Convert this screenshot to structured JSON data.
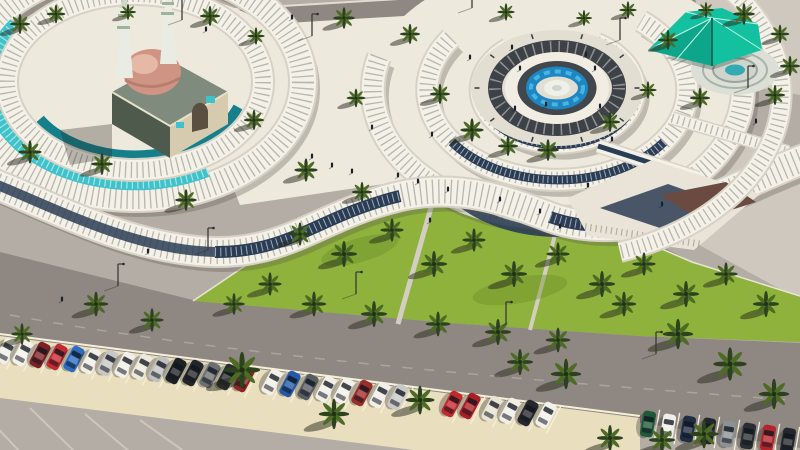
{
  "meta": {
    "type": "architectural-aerial-render",
    "description": "Aerial 3D architectural rendering of a mosque plaza: curved white lattice canopies spiral around a circular fountain plaza, a mosque with a pink dome and twin minarets sits inside a ringed arcade with teal glass, a teal tensile shade pavilion stands at the upper right, rows of palm trees cover a bright green lawn, and an angled parking strip full of colored cars runs along the bottom."
  },
  "labels": {
    "mosque": "mosque with dome and twin minarets",
    "arcade": "curved arcade with teal glass canopy",
    "fountain": "central circular fountain plaza",
    "pavilion": "teal tensile shade pavilion",
    "promenade": "curved shaded promenade walkway",
    "lawn": "palm grove lawn",
    "parking": "angled parking row",
    "road": "perimeter road"
  },
  "palette": {
    "base": "#b4ada5",
    "pavementLight": "#cfc8be",
    "road": "#8f8882",
    "roadUpper": "#989089",
    "plaza": "#eee9dd",
    "plazaBright": "#f4f1e8",
    "bandEdge": "#d7d2c5",
    "navy": "#2b3d55",
    "tealGlass": "#3fc3cb",
    "tealDark": "#157f8c",
    "lawn": "#8eb23c",
    "lawnDark": "#74982f",
    "palm": "#2c421c",
    "palmLight": "#4c6b24",
    "shadow": "rgba(38,40,28,0.5)",
    "parking": "#e9dfbf",
    "parkLine": "#f6f0da",
    "mosqueRoof": "#7e8b7d",
    "mosqueSide": "#4e5a4c",
    "mosqueFacade": "#d6cbae",
    "domeLight": "#e9c0ac",
    "domeDark": "#cf9483",
    "minaret": "#e9ece3",
    "minaretBand": "#9db39b",
    "pavilion": "#13c1a1",
    "pavilionDark": "#0b9078",
    "waterLight": "#47b4e4",
    "water": "#1e87c2",
    "fountainDark": "#3c4247",
    "person": "#1b212b"
  },
  "palms": [
    [
      20,
      24,
      0.7
    ],
    [
      56,
      14,
      0.65
    ],
    [
      128,
      12,
      0.55
    ],
    [
      210,
      16,
      0.7
    ],
    [
      256,
      36,
      0.6
    ],
    [
      344,
      18,
      0.75
    ],
    [
      410,
      34,
      0.7
    ],
    [
      506,
      12,
      0.6
    ],
    [
      584,
      18,
      0.55
    ],
    [
      628,
      10,
      0.6
    ],
    [
      668,
      40,
      0.7
    ],
    [
      706,
      10,
      0.55
    ],
    [
      744,
      14,
      0.75
    ],
    [
      780,
      34,
      0.65
    ],
    [
      790,
      66,
      0.7
    ],
    [
      30,
      152,
      0.8
    ],
    [
      102,
      164,
      0.75
    ],
    [
      254,
      120,
      0.7
    ],
    [
      306,
      170,
      0.8
    ],
    [
      186,
      200,
      0.75
    ],
    [
      356,
      98,
      0.65
    ],
    [
      440,
      94,
      0.7
    ],
    [
      472,
      130,
      0.8
    ],
    [
      610,
      122,
      0.7
    ],
    [
      648,
      90,
      0.6
    ],
    [
      700,
      98,
      0.7
    ],
    [
      548,
      150,
      0.75
    ],
    [
      362,
      192,
      0.7
    ],
    [
      775,
      95,
      0.7
    ],
    [
      508,
      146,
      0.7
    ],
    [
      300,
      234,
      0.8
    ],
    [
      344,
      254,
      0.9
    ],
    [
      392,
      230,
      0.8
    ],
    [
      434,
      264,
      0.9
    ],
    [
      474,
      240,
      0.8
    ],
    [
      514,
      274,
      0.9
    ],
    [
      558,
      254,
      0.8
    ],
    [
      602,
      284,
      0.9
    ],
    [
      644,
      264,
      0.8
    ],
    [
      686,
      294,
      0.9
    ],
    [
      726,
      274,
      0.8
    ],
    [
      766,
      304,
      0.9
    ],
    [
      270,
      284,
      0.8
    ],
    [
      234,
      304,
      0.75
    ],
    [
      314,
      304,
      0.85
    ],
    [
      374,
      314,
      0.9
    ],
    [
      438,
      324,
      0.85
    ],
    [
      498,
      332,
      0.9
    ],
    [
      558,
      340,
      0.85
    ],
    [
      96,
      304,
      0.85
    ],
    [
      152,
      320,
      0.8
    ],
    [
      242,
      370,
      1.25
    ],
    [
      334,
      414,
      1.05
    ],
    [
      420,
      400,
      1.0
    ],
    [
      566,
      374,
      1.05
    ],
    [
      624,
      304,
      0.85
    ],
    [
      678,
      334,
      1.05
    ],
    [
      730,
      364,
      1.15
    ],
    [
      774,
      394,
      1.05
    ],
    [
      704,
      434,
      1.0
    ],
    [
      610,
      438,
      0.9
    ],
    [
      22,
      334,
      0.75
    ],
    [
      662,
      440,
      0.9
    ],
    [
      520,
      362,
      0.9
    ]
  ],
  "cars": [
    [
      6,
      351,
      28,
      "#f1efe8"
    ],
    [
      23,
      353,
      28,
      "#f3f1ea"
    ],
    [
      40,
      355,
      28,
      "#7c2125"
    ],
    [
      57,
      357,
      28,
      "#c22a30"
    ],
    [
      74,
      359,
      28,
      "#2e6cc0"
    ],
    [
      91,
      361,
      28,
      "#f1efe8"
    ],
    [
      108,
      363,
      28,
      "#c8c8c6"
    ],
    [
      125,
      365,
      28,
      "#f1efe8"
    ],
    [
      142,
      367,
      28,
      "#eceade"
    ],
    [
      159,
      369,
      28,
      "#bfc0bf"
    ],
    [
      176,
      371,
      28,
      "#1e2124"
    ],
    [
      193,
      373,
      28,
      "#232629"
    ],
    [
      210,
      375,
      28,
      "#6d7073"
    ],
    [
      227,
      377,
      28,
      "#2a2d30"
    ],
    [
      244,
      379,
      28,
      "#8e2424"
    ],
    [
      272,
      382,
      28,
      "#f1efe8"
    ],
    [
      290,
      384,
      28,
      "#2558a6"
    ],
    [
      308,
      387,
      28,
      "#585d63"
    ],
    [
      326,
      389,
      28,
      "#f1efe8"
    ],
    [
      344,
      391,
      28,
      "#f3f1ea"
    ],
    [
      362,
      393,
      28,
      "#9b2c2c"
    ],
    [
      380,
      395,
      28,
      "#f1efe8"
    ],
    [
      398,
      397,
      28,
      "#c9c9c7"
    ],
    [
      452,
      404,
      28,
      "#c3282e"
    ],
    [
      470,
      406,
      28,
      "#a82026"
    ],
    [
      492,
      409,
      28,
      "#e8e4d2"
    ],
    [
      510,
      411,
      28,
      "#f1efe8"
    ],
    [
      528,
      413,
      28,
      "#25282c"
    ],
    [
      546,
      415,
      28,
      "#f3f1ea"
    ],
    [
      648,
      424,
      10,
      "#20593a"
    ],
    [
      668,
      427,
      10,
      "#f0eee6"
    ],
    [
      688,
      429,
      10,
      "#1e2c44"
    ],
    [
      708,
      431,
      10,
      "#23262a"
    ],
    [
      728,
      434,
      10,
      "#8d9195"
    ],
    [
      748,
      436,
      10,
      "#2a2e33"
    ],
    [
      768,
      438,
      10,
      "#b3242b"
    ],
    [
      788,
      441,
      10,
      "#23262e"
    ]
  ],
  "people": [
    [
      312,
      158
    ],
    [
      332,
      167
    ],
    [
      352,
      173
    ],
    [
      398,
      177
    ],
    [
      418,
      183
    ],
    [
      448,
      191
    ],
    [
      500,
      201
    ],
    [
      540,
      213
    ],
    [
      588,
      187
    ],
    [
      470,
      59
    ],
    [
      512,
      49
    ],
    [
      586,
      56
    ],
    [
      612,
      141
    ],
    [
      662,
      206
    ],
    [
      756,
      123
    ],
    [
      62,
      301
    ],
    [
      148,
      253
    ],
    [
      206,
      31
    ],
    [
      292,
      19
    ],
    [
      372,
      129
    ],
    [
      432,
      136
    ],
    [
      546,
      106
    ],
    [
      430,
      222
    ],
    [
      560,
      228
    ],
    [
      520,
      70
    ],
    [
      595,
      70
    ],
    [
      515,
      110
    ],
    [
      600,
      108
    ]
  ],
  "poles": [
    [
      208,
      250
    ],
    [
      356,
      294
    ],
    [
      506,
      324
    ],
    [
      656,
      354
    ],
    [
      182,
      20
    ],
    [
      312,
      36
    ],
    [
      472,
      8
    ],
    [
      620,
      40
    ],
    [
      748,
      88
    ],
    [
      118,
      286
    ]
  ]
}
